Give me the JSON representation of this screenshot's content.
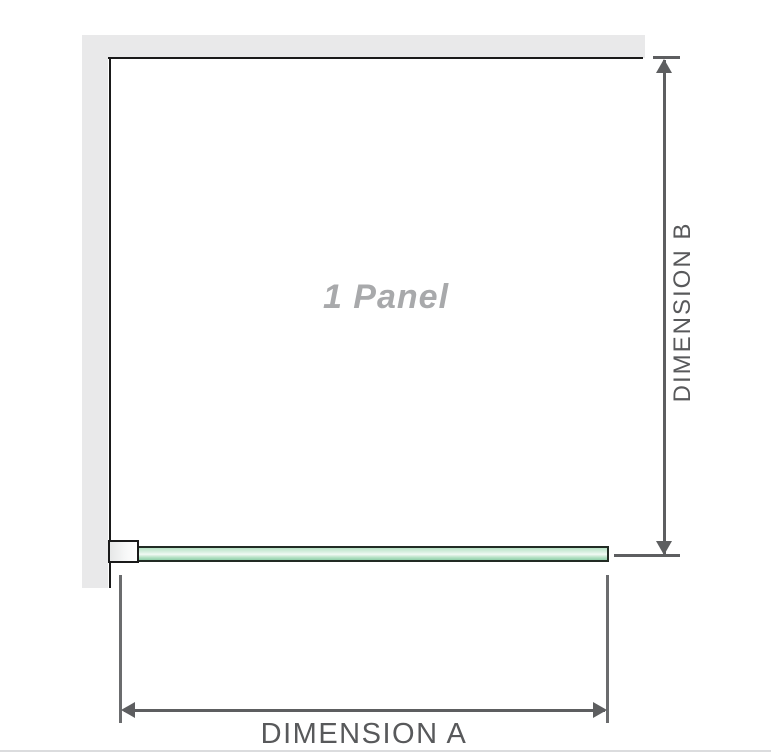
{
  "diagram": {
    "panel_label": "1 Panel",
    "dimension_a_label": "DIMENSION A",
    "dimension_b_label": "DIMENSION B"
  },
  "colors": {
    "wall": "#e9e9ea",
    "outline": "#1a1a1a",
    "dimension_line": "#5d5e60",
    "extension_line": "#6b6c6e",
    "dimension_text": "#58595b",
    "panel_label_text": "#a8a9ab",
    "glass_border": "#222b24",
    "glass_light": "#e0f3e7",
    "glass_mid": "#b7e2c6",
    "glass_dark": "#8fcfa9",
    "baseline": "#dbdcde"
  }
}
